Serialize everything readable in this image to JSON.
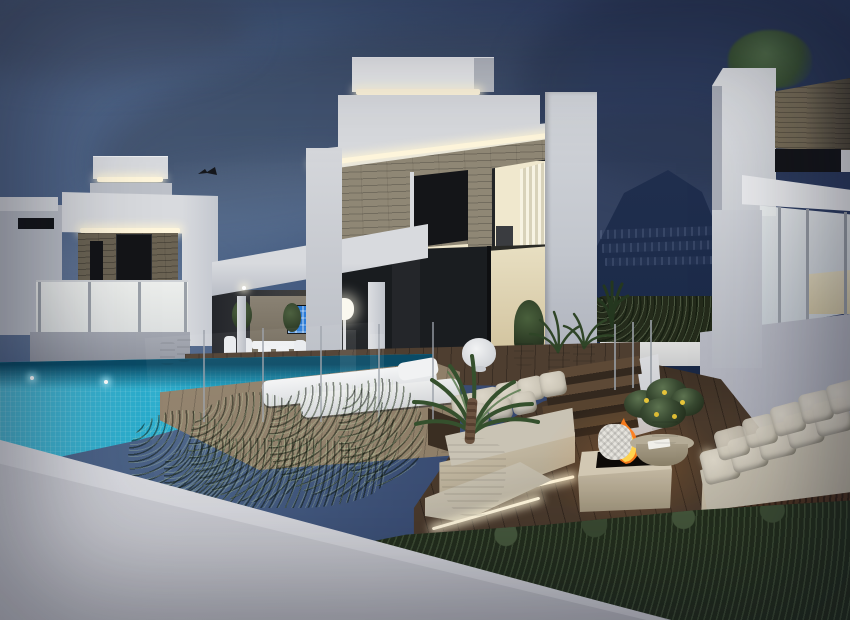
{
  "scene": {
    "type": "architectural-dusk-render",
    "subject": "Modern two-storey white villas at dusk with infinity pool, timber deck, outdoor lounge with fire pit, hedges and a mountain backdrop",
    "time_of_day": "dusk",
    "colors": {
      "sky-left": "#54698C",
      "sky-right": "#2A3A5F",
      "mountain": "#1B2A48",
      "white-bright": "#EDEEF0",
      "white-mid": "#D8DADE",
      "white-dim": "#BCC0C8",
      "white-shadow": "#A2A6B0",
      "stone": "#8F8775",
      "stone-dark": "#6B6353",
      "wood-clad": "#7B7059",
      "window-dark": "#141518",
      "window-warm": "#F0E8CE",
      "led": "#FFF6DC",
      "pool": "#1EA8CA",
      "pool-deep": "#0A4B66",
      "deck": "#4A3A2C",
      "deck-lit": "#8F7F69",
      "hedge": "#374830",
      "hedge-dark": "#232E1C",
      "hedge-light": "#5D7350",
      "cushion": "#C9C3B4",
      "cushion-light": "#DCD6C8",
      "travertine": "#CFC5B0",
      "fire-orange": "#FF7D1C",
      "fire-yellow": "#FFD34E",
      "wall-fg": "#C6C7CD",
      "soil": "#4A3322",
      "interior-warm": "#D9D0B4",
      "tv-blue": "#2B7CD8"
    },
    "objects": {
      "sky": "dusk sky with grey-blue cloud streaks",
      "mountain": "dark mountainside with rows of distant apartment buildings",
      "left_villa": "white villa with stone accent band, LED cove lighting, dark windows and frosted-glass balcony",
      "main_villa": "two-storey white villa, stone-clad upper floor, warm-lit windows with vertical blinds, rooftop LED strips, interior staircase, covered terrace with wall TV, white dining set and glowing floor lamp",
      "right_villa": "white villa with timber-clad band, dark window, glass balcony railing and rooftop shrub",
      "bird": "bird silhouette above the left villa roof",
      "pool": "turquoise tiled infinity pool with underwater lights",
      "loungers": "two white sun loungers on a lit timber platform",
      "lounge": "sunken lounge with two beige cushioned sofas, square travertine fire pit with flames, round stone coffee table, potted lemon tree, woven basket and potted palm",
      "steps": "timber steps with LED strip lighting and glass balustrade",
      "hedges": "clipped green hedges along the deck and boundary",
      "foreground_wall": "diagonal white boundary wall in the foreground"
    }
  }
}
